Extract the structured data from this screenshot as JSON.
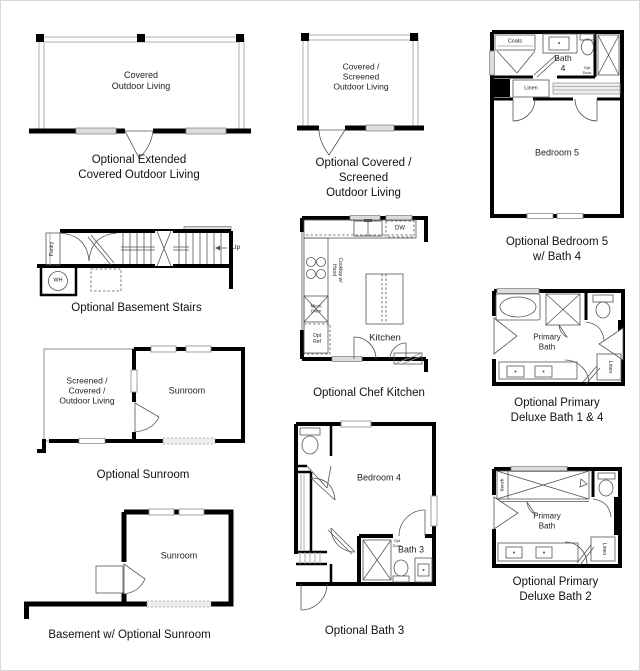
{
  "page": {
    "background": "#ffffff",
    "wall_color": "#000000",
    "caption_color": "#111111"
  },
  "plans": {
    "extended_outdoor": {
      "room_label": "Covered\nOutdoor Living",
      "caption": "Optional Extended\nCovered Outdoor Living"
    },
    "covered_screened": {
      "room_label": "Covered / Screened\nOutdoor Living",
      "caption": "Optional Covered / Screened\nOutdoor Living"
    },
    "bedroom5_bath4": {
      "coats_label": "Coats",
      "bath_label": "Bath\n4",
      "opt_door_label": "Opt\nDoor",
      "linen_label": "Linen",
      "bedroom_label": "Bedroom 5",
      "caption": "Optional Bedroom 5\nw/ Bath 4"
    },
    "basement_stairs": {
      "pantry_label": "Pantry",
      "wh_label": "WH",
      "up_label": "Up",
      "caption": "Optional Basement Stairs"
    },
    "chef_kitchen": {
      "dw_label": "DW",
      "cooktop_label": "Cooktop w/\nHood",
      "micro_oven_label": "Micro\nOven",
      "opt_ref_label": "Opt\nRef",
      "kitchen_label": "Kitchen",
      "caption": "Optional Chef Kitchen"
    },
    "primary_bath_1_4": {
      "room_label": "Primary\nBath",
      "linen_label": "Linen",
      "caption": "Optional Primary\nDeluxe Bath 1 & 4"
    },
    "optional_sunroom": {
      "left_room_label": "Screened /\nCovered /\nOutdoor Living",
      "sunroom_label": "Sunroom",
      "caption": "Optional Sunroom"
    },
    "basement_sunroom": {
      "sunroom_label": "Sunroom",
      "caption": "Basement w/ Optional Sunroom"
    },
    "bath3": {
      "bedroom_label": "Bedroom 4",
      "bath_label": "Bath 3",
      "opt_door_label": "Opt\nDoor",
      "caption": "Optional Bath 3"
    },
    "primary_bath_2": {
      "room_label": "Primary\nBath",
      "bench_label": "Bench",
      "linen_label": "Linen",
      "caption": "Optional Primary\nDeluxe Bath 2"
    }
  }
}
